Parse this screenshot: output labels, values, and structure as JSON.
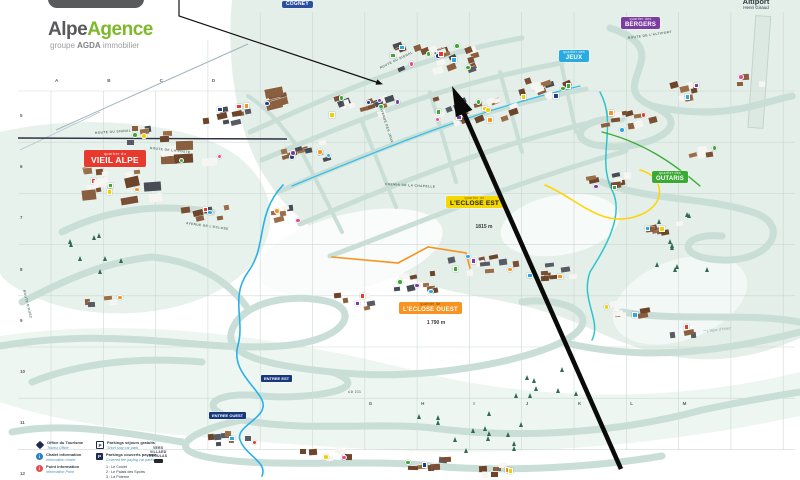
{
  "brand": {
    "name_gray": "Alpe",
    "name_green": "Agence",
    "tagline_pre": "groupe ",
    "tagline_bold": "AGDA",
    "tagline_post": " immobilier"
  },
  "districts": {
    "cogney": {
      "name": "COGNEY",
      "color": "#2b4fa0"
    },
    "jeux": {
      "prefix": "quartier des",
      "name": "JEUX",
      "color": "#29abe2"
    },
    "bergers": {
      "prefix": "quartier des",
      "name": "BERGERS",
      "color": "#7c3da2"
    },
    "vieil_alpe": {
      "prefix": "quartier du",
      "name": "VIEIL ALPE",
      "color": "#e8392e"
    },
    "eclose_est": {
      "prefix": "quartier de",
      "name": "L'ECLOSE EST",
      "altitude": "1815 m",
      "color": "#f5d800"
    },
    "eclose_ouest": {
      "prefix": "quartier de",
      "name": "L'ECLOSE OUEST",
      "altitude": "1 790 m",
      "color": "#f7931e"
    },
    "outaris": {
      "prefix": "quartier des",
      "name": "OUTARIS",
      "color": "#3aaa35"
    }
  },
  "poi": {
    "altiport_line1": "Altiport",
    "altiport_line2": "Henri Giraud",
    "entree_est": "ENTREE EST",
    "entree_ouest": "ENTREE OUEST",
    "vers_villard": [
      "VERS",
      "VILLARD",
      "RECULAS"
    ],
    "resort_mark": "L'Alpe d'Huez"
  },
  "road_labels": [
    {
      "text": "ROUTE DU SIGNAL",
      "x": 95,
      "y": 131,
      "rot": -4
    },
    {
      "text": "ROUTE DE LA POSTE",
      "x": 150,
      "y": 146,
      "rot": 6
    },
    {
      "text": "ROUTE DU SIGNAL",
      "x": 380,
      "y": 66,
      "rot": -26
    },
    {
      "text": "AVENUE DES JEUX",
      "x": 381,
      "y": 106,
      "rot": 72
    },
    {
      "text": "CHEMIN DE LA CHAPELLE",
      "x": 385,
      "y": 182,
      "rot": 3
    },
    {
      "text": "AVENUE DE L'ECLOSE",
      "x": 186,
      "y": 221,
      "rot": 8
    },
    {
      "text": "ROUTE D'HUEZ",
      "x": 24,
      "y": 288,
      "rot": 76
    },
    {
      "text": "CD 211",
      "x": 348,
      "y": 390,
      "rot": -2
    },
    {
      "text": "ROUTE DE L'ALTIPORT",
      "x": 628,
      "y": 36,
      "rot": -8
    }
  ],
  "grid": {
    "top_letters": [
      "A",
      "B",
      "C",
      "D"
    ],
    "bottom_letters": [
      "G",
      "H",
      "I",
      "J",
      "K",
      "L",
      "M"
    ],
    "left_numbers": [
      "5",
      "6",
      "7",
      "8",
      "9",
      "10",
      "11",
      "12"
    ]
  },
  "legend": {
    "items_left": [
      {
        "icon": "tourism-diamond",
        "fr": "Office du Tourisme",
        "en": "Tourist Office"
      },
      {
        "icon": "info-blue",
        "fr": "Chalet information",
        "en": "Information chalet"
      },
      {
        "icon": "info-red",
        "fr": "Point information",
        "en": "Information Point"
      }
    ],
    "items_right": [
      {
        "icon": "parking-open",
        "fr": "Parkings séjours gratuits",
        "en": "Short stay car park"
      },
      {
        "icon": "parking-covered",
        "fr": "Parkings couverts payants",
        "en": "Covered fee paying car parks"
      }
    ],
    "parking_list": [
      "1 : Le Coulet",
      "2 : Le Palais des Sports",
      "3 : La Poterne"
    ],
    "parking_glyph": "P",
    "info_glyph": "i"
  },
  "colors": {
    "terrain": "#e3efe8",
    "road": "#c9ded6",
    "piste_blue": "#2bb0e8",
    "piste_teal": "#2fc4cc",
    "piste_orange": "#f7931e",
    "piste_yellow": "#ffd400",
    "arrow": "#0a0a0a"
  }
}
